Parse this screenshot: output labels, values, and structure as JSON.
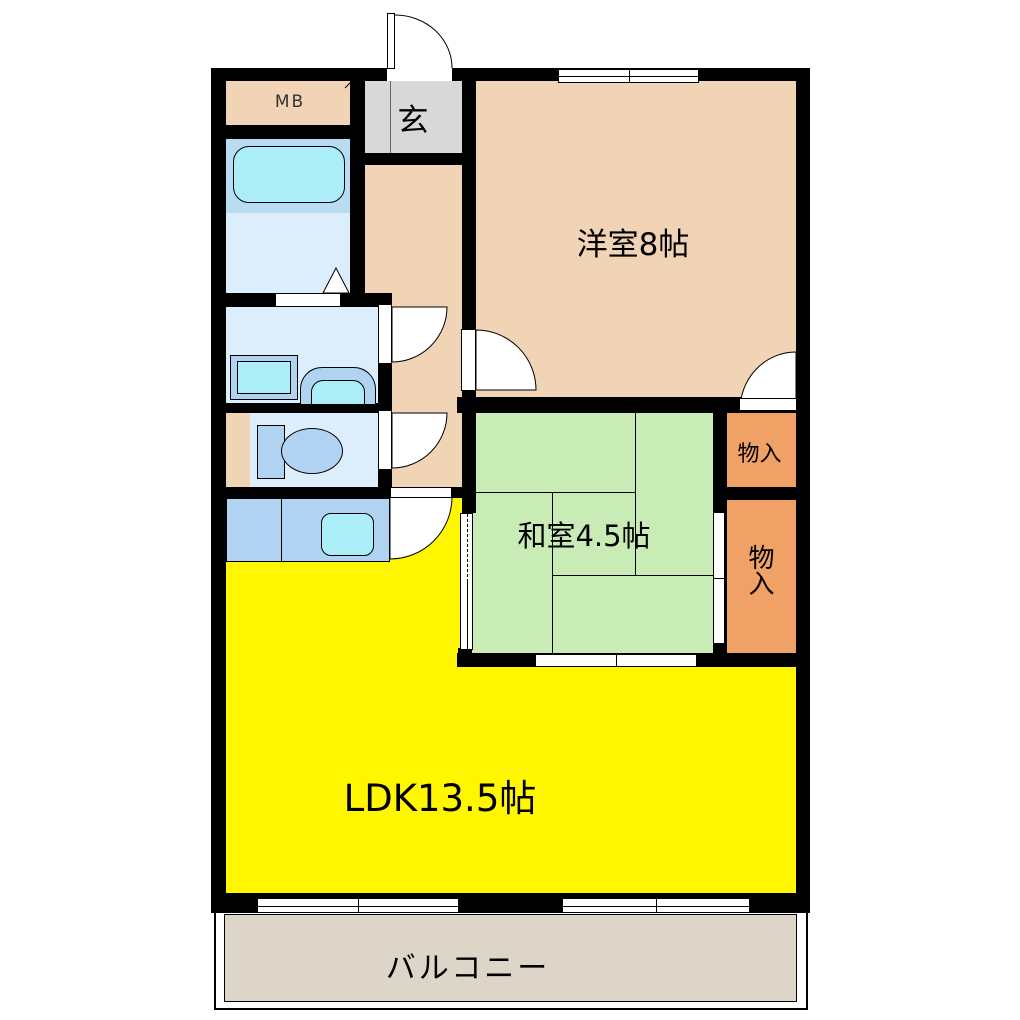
{
  "rooms": {
    "meter_box": {
      "label": "MB"
    },
    "entrance": {
      "label": "玄"
    },
    "western": {
      "label": "洋室8帖"
    },
    "japanese": {
      "label": "和室4.5帖"
    },
    "storage_upper": {
      "label": "物入"
    },
    "storage_lower": {
      "label": "物入"
    },
    "ldk": {
      "label": "LDK13.5帖"
    },
    "balcony": {
      "label": "バルコニー"
    }
  },
  "colors": {
    "room_peach": "#f1d3b5",
    "entrance_gray": "#d8d8d8",
    "tatami_green": "#c9ecb6",
    "storage_orange": "#f0a165",
    "ldk_yellow": "#fff600",
    "balcony_beige": "#ded5c9",
    "fixture_blue": "#b0d3f2",
    "water_cyan": "#aceef8",
    "bath_blue": "#b9dcf4",
    "wet_room_lightblue": "#dcedfb",
    "wall_black": "#000000"
  }
}
